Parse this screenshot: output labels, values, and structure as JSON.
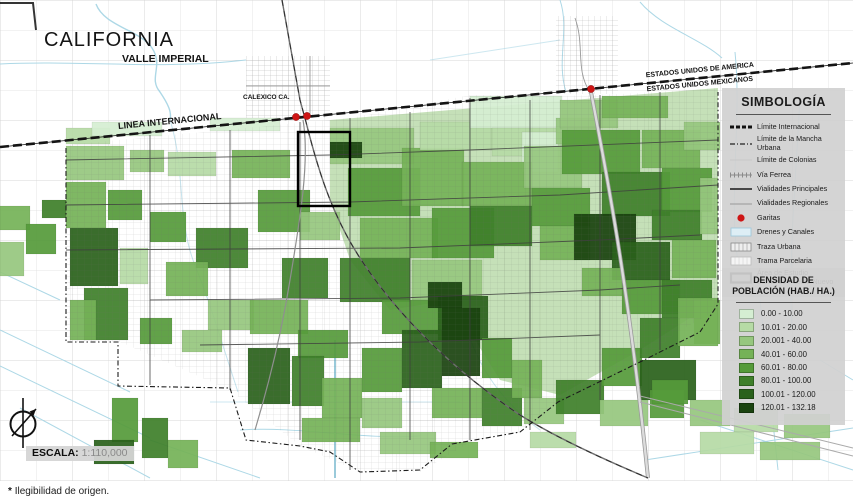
{
  "map": {
    "labels": {
      "region": "CALIFORNIA",
      "valley": "VALLE IMPERIAL",
      "city": "CALEXICO CA.",
      "border_line": "LINEA INTERNACIONAL",
      "usa_side": "ESTADOS UNIDOS DE AMERICA",
      "mx_side": "ESTADOS UNIDOS MEXICANOS"
    },
    "scale": {
      "label": "ESCALA:",
      "value": "1:110,000"
    },
    "garitas": [
      {
        "x": 296,
        "y": 117
      },
      {
        "x": 307,
        "y": 116
      },
      {
        "x": 591,
        "y": 89
      }
    ],
    "accent_red": "#ce1515",
    "canal_blue": "#a9d6e5",
    "density_colors": [
      "#d5eed2",
      "#b6dba5",
      "#96c77e",
      "#75b257",
      "#559b3a",
      "#3e7f2a",
      "#2a611b",
      "#1a430f"
    ],
    "blocks": [
      [
        66,
        128,
        44,
        16,
        1
      ],
      [
        92,
        122,
        70,
        14,
        0
      ],
      [
        210,
        118,
        70,
        13,
        0
      ],
      [
        66,
        146,
        58,
        34,
        2
      ],
      [
        66,
        182,
        40,
        46,
        3
      ],
      [
        70,
        228,
        48,
        58,
        6
      ],
      [
        84,
        288,
        44,
        52,
        5
      ],
      [
        70,
        300,
        26,
        40,
        3
      ],
      [
        108,
        190,
        34,
        30,
        4
      ],
      [
        130,
        150,
        34,
        22,
        2
      ],
      [
        168,
        152,
        48,
        24,
        1
      ],
      [
        150,
        212,
        36,
        30,
        4
      ],
      [
        196,
        228,
        52,
        40,
        5
      ],
      [
        166,
        262,
        42,
        34,
        3
      ],
      [
        208,
        300,
        46,
        30,
        2
      ],
      [
        140,
        318,
        32,
        26,
        4
      ],
      [
        182,
        330,
        40,
        22,
        2
      ],
      [
        120,
        248,
        28,
        36,
        1
      ],
      [
        232,
        150,
        58,
        28,
        3
      ],
      [
        258,
        190,
        52,
        42,
        4
      ],
      [
        300,
        212,
        40,
        28,
        2
      ],
      [
        282,
        258,
        46,
        40,
        5
      ],
      [
        250,
        300,
        58,
        34,
        3
      ],
      [
        298,
        330,
        50,
        28,
        4
      ],
      [
        0,
        206,
        30,
        24,
        3
      ],
      [
        26,
        224,
        30,
        30,
        4
      ],
      [
        0,
        242,
        24,
        34,
        2
      ],
      [
        42,
        200,
        24,
        18,
        5
      ],
      [
        330,
        128,
        84,
        36,
        2
      ],
      [
        348,
        168,
        72,
        48,
        4
      ],
      [
        330,
        142,
        32,
        16,
        7
      ],
      [
        360,
        218,
        78,
        40,
        3
      ],
      [
        340,
        258,
        70,
        44,
        5
      ],
      [
        402,
        148,
        62,
        58,
        3
      ],
      [
        420,
        122,
        72,
        28,
        1
      ],
      [
        432,
        208,
        62,
        50,
        4
      ],
      [
        412,
        260,
        70,
        40,
        2
      ],
      [
        382,
        300,
        62,
        34,
        4
      ],
      [
        438,
        296,
        50,
        44,
        6
      ],
      [
        428,
        282,
        34,
        26,
        7
      ],
      [
        470,
        96,
        92,
        32,
        0
      ],
      [
        492,
        128,
        70,
        28,
        1
      ],
      [
        522,
        132,
        36,
        40,
        0
      ],
      [
        462,
        162,
        70,
        44,
        3
      ],
      [
        470,
        206,
        62,
        40,
        5
      ],
      [
        524,
        146,
        58,
        42,
        2
      ],
      [
        532,
        188,
        58,
        38,
        4
      ],
      [
        540,
        226,
        50,
        34,
        3
      ],
      [
        556,
        118,
        44,
        26,
        2
      ],
      [
        560,
        100,
        58,
        28,
        2
      ],
      [
        602,
        96,
        66,
        22,
        3
      ],
      [
        562,
        130,
        78,
        44,
        4
      ],
      [
        602,
        172,
        68,
        44,
        5
      ],
      [
        574,
        214,
        62,
        46,
        7
      ],
      [
        612,
        242,
        58,
        38,
        6
      ],
      [
        642,
        130,
        58,
        38,
        3
      ],
      [
        662,
        168,
        50,
        44,
        4
      ],
      [
        652,
        210,
        50,
        30,
        5
      ],
      [
        672,
        240,
        44,
        38,
        3
      ],
      [
        684,
        122,
        36,
        28,
        2
      ],
      [
        700,
        178,
        18,
        56,
        2
      ],
      [
        622,
        280,
        58,
        34,
        4
      ],
      [
        582,
        268,
        40,
        28,
        3
      ],
      [
        662,
        280,
        50,
        38,
        5
      ],
      [
        694,
        300,
        26,
        44,
        3
      ],
      [
        248,
        348,
        42,
        56,
        6
      ],
      [
        292,
        356,
        32,
        50,
        5
      ],
      [
        322,
        378,
        40,
        40,
        3
      ],
      [
        362,
        348,
        40,
        44,
        4
      ],
      [
        402,
        330,
        40,
        58,
        6
      ],
      [
        442,
        308,
        38,
        68,
        7
      ],
      [
        482,
        338,
        30,
        40,
        4
      ],
      [
        432,
        388,
        50,
        30,
        3
      ],
      [
        362,
        398,
        40,
        30,
        2
      ],
      [
        302,
        418,
        58,
        24,
        3
      ],
      [
        482,
        388,
        40,
        38,
        5
      ],
      [
        512,
        360,
        30,
        38,
        3
      ],
      [
        524,
        398,
        40,
        26,
        2
      ],
      [
        556,
        380,
        48,
        34,
        5
      ],
      [
        602,
        348,
        40,
        38,
        4
      ],
      [
        640,
        318,
        40,
        40,
        5
      ],
      [
        678,
        298,
        40,
        48,
        3
      ],
      [
        112,
        398,
        26,
        44,
        4
      ],
      [
        142,
        418,
        26,
        40,
        5
      ],
      [
        168,
        440,
        30,
        28,
        3
      ],
      [
        94,
        440,
        40,
        24,
        6
      ],
      [
        640,
        360,
        56,
        40,
        6
      ],
      [
        650,
        390,
        34,
        28,
        4
      ],
      [
        690,
        400,
        40,
        26,
        2
      ],
      [
        734,
        408,
        44,
        24,
        1
      ],
      [
        784,
        414,
        46,
        24,
        2
      ],
      [
        700,
        432,
        54,
        22,
        1
      ],
      [
        760,
        442,
        60,
        18,
        2
      ],
      [
        380,
        432,
        56,
        22,
        2
      ],
      [
        430,
        442,
        48,
        16,
        3
      ],
      [
        530,
        432,
        46,
        16,
        1
      ],
      [
        600,
        400,
        48,
        26,
        2
      ],
      [
        652,
        380,
        36,
        24,
        4
      ]
    ]
  },
  "simbologia": {
    "title": "SIMBOLOGÍA",
    "items": [
      {
        "label": "Límite Internacional",
        "symbol": "border-international"
      },
      {
        "label": "Límite de la Mancha Urbana",
        "symbol": "border-urban"
      },
      {
        "label": "Límite de Colonias",
        "symbol": "border-colonias"
      },
      {
        "label": "Vía Ferrea",
        "symbol": "railroad"
      },
      {
        "label": "Vialidades Principales",
        "symbol": "road-primary"
      },
      {
        "label": "Vialidades Regionales",
        "symbol": "road-regional"
      },
      {
        "label": "Garitas",
        "symbol": "garita-dot"
      },
      {
        "label": "Drenes y Canales",
        "symbol": "canal-box"
      },
      {
        "label": "Traza Urbana",
        "symbol": "urban-hatch-box"
      },
      {
        "label": "Trama Parcelaria",
        "symbol": "parcel-hatch-box"
      },
      {
        "label": "Área de Estudio",
        "label2": "Barrio de Pueblo Nuevo",
        "symbol": "study-area-box"
      }
    ]
  },
  "densidad": {
    "title_line1": "DENSIDAD DE",
    "title_line2": "POBLACIÓN (HAB./ HA.)",
    "classes": [
      {
        "range": "0.00 - 10.00",
        "color_index": 0
      },
      {
        "range": "10.01 - 20.00",
        "color_index": 1
      },
      {
        "range": "20.001 - 40.00",
        "color_index": 2
      },
      {
        "range": "40.01 - 60.00",
        "color_index": 3
      },
      {
        "range": "60.01 - 80.00",
        "color_index": 4
      },
      {
        "range": "80.01 - 100.00",
        "color_index": 5
      },
      {
        "range": "100.01 - 120.00",
        "color_index": 6
      },
      {
        "range": "120.01 - 132.18",
        "color_index": 7
      }
    ]
  },
  "footnote": {
    "marker": "*",
    "text": "Ilegibilidad de origen."
  }
}
